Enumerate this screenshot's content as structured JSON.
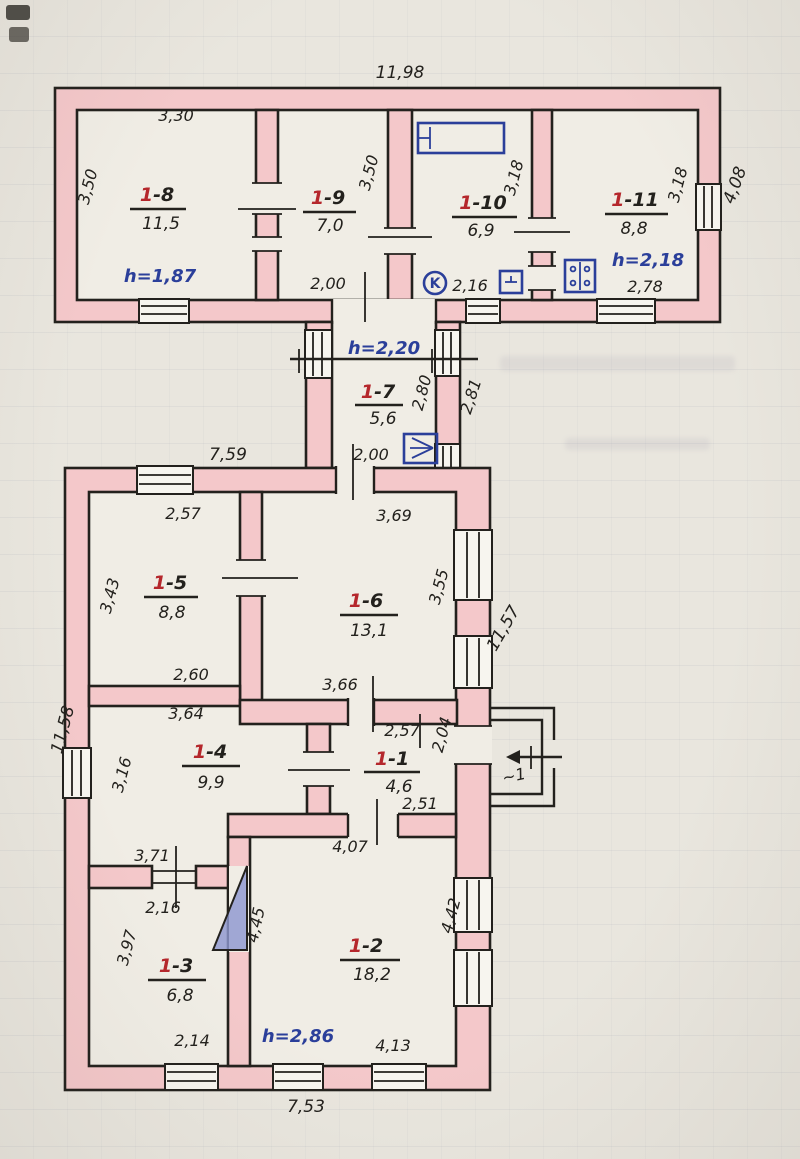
{
  "colors": {
    "paper": "#e9e6de",
    "room_fill": "#f0ede5",
    "wall_fill": "#f4c8ca",
    "ink": "#23211d",
    "room_number_red": "#b5272c",
    "note_blue": "#2b3f9a",
    "cellar_shade": "#8d97cf"
  },
  "plan": {
    "top_building": {
      "width_total": "11,98",
      "height_right": "4,08",
      "room_1_8": {
        "num": "1",
        "suffix": "-8",
        "area": "11,5",
        "w_top": "3,30",
        "h_left": "3,50",
        "ceiling": "h=1,87"
      },
      "room_1_9": {
        "num": "1",
        "suffix": "-9",
        "area": "7,0",
        "h_right": "3,50",
        "w_bottom": "2,00"
      },
      "room_1_10": {
        "num": "1",
        "suffix": "-10",
        "area": "6,9",
        "h_right": "3,18",
        "w_bottom": "2,16",
        "tag": "K"
      },
      "room_1_11": {
        "num": "1",
        "suffix": "-11",
        "area": "8,8",
        "h_right": "3,18",
        "w_bottom": "2,78",
        "ceiling": "h=2,18"
      }
    },
    "link_passage": {
      "ceiling": "h=2,20",
      "room_1_7": {
        "num": "1",
        "suffix": "-7",
        "area": "5,6"
      },
      "h_inner": "2,80",
      "h_outer": "2,81",
      "w_bottom": "2,00"
    },
    "lower_building": {
      "width_top": "7,59",
      "height_left": "11,58",
      "height_right": "11,57",
      "width_bottom": "7,53",
      "room_1_5": {
        "num": "1",
        "suffix": "-5",
        "area": "8,8",
        "w_top": "2,57",
        "h_left": "3,43",
        "w_bottom": "2,60"
      },
      "room_1_6": {
        "num": "1",
        "suffix": "-6",
        "area": "13,1",
        "w_top": "3,69",
        "h_right": "3,55",
        "w_bottom": "3,66"
      },
      "room_1_4": {
        "num": "1",
        "suffix": "-4",
        "area": "9,9",
        "w_top": "3,64",
        "h_left": "3,16",
        "w_bottom": "3,71",
        "door_w": "2,16"
      },
      "room_1_1": {
        "num": "1",
        "suffix": "-1",
        "area": "4,6",
        "w_top": "2,57",
        "w_bottom": "2,51",
        "h_right": "2,04"
      },
      "room_1_2": {
        "num": "1",
        "suffix": "-2",
        "area": "18,2",
        "w_top": "4,07",
        "h_left": "4,45",
        "h_right": "4,42",
        "w_bottom": "4,13",
        "ceiling": "h=2,86"
      },
      "room_1_3": {
        "num": "1",
        "suffix": "-3",
        "area": "6,8",
        "h_left": "3,97",
        "w_bottom": "2,14"
      },
      "porch": {
        "label": "~1"
      }
    }
  }
}
